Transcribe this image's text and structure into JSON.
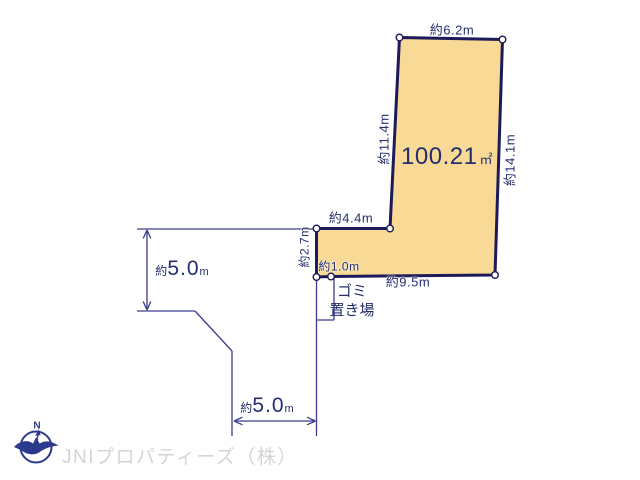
{
  "colors": {
    "background": "#ffffff",
    "plot_fill": "#f8d995",
    "plot_border": "#1c1a58",
    "dimension_line": "#3c3c8c",
    "label_text": "#242e6e",
    "logo_navy": "#2b3a8c",
    "logo_text_gray": "#d4d4d6"
  },
  "plot": {
    "area_value": "100.21",
    "area_unit": "㎡",
    "dim_top": "約6.2m",
    "dim_left_upper": "約11.4m",
    "dim_right": "約14.1m",
    "dim_step": "約4.4m",
    "dim_left_lower": "約2.7m",
    "dim_bottom_small": "約1.0m",
    "dim_bottom": "約9.5m"
  },
  "roads": {
    "left": {
      "prefix": "約",
      "value": "5.0",
      "unit": "m"
    },
    "bottom": {
      "prefix": "約",
      "value": "5.0",
      "unit": "m"
    }
  },
  "garbage": {
    "line1": "ゴミ",
    "line2": "置き場"
  },
  "logo": {
    "compass_n": "N",
    "company": "JNIプロパティーズ（株）"
  }
}
